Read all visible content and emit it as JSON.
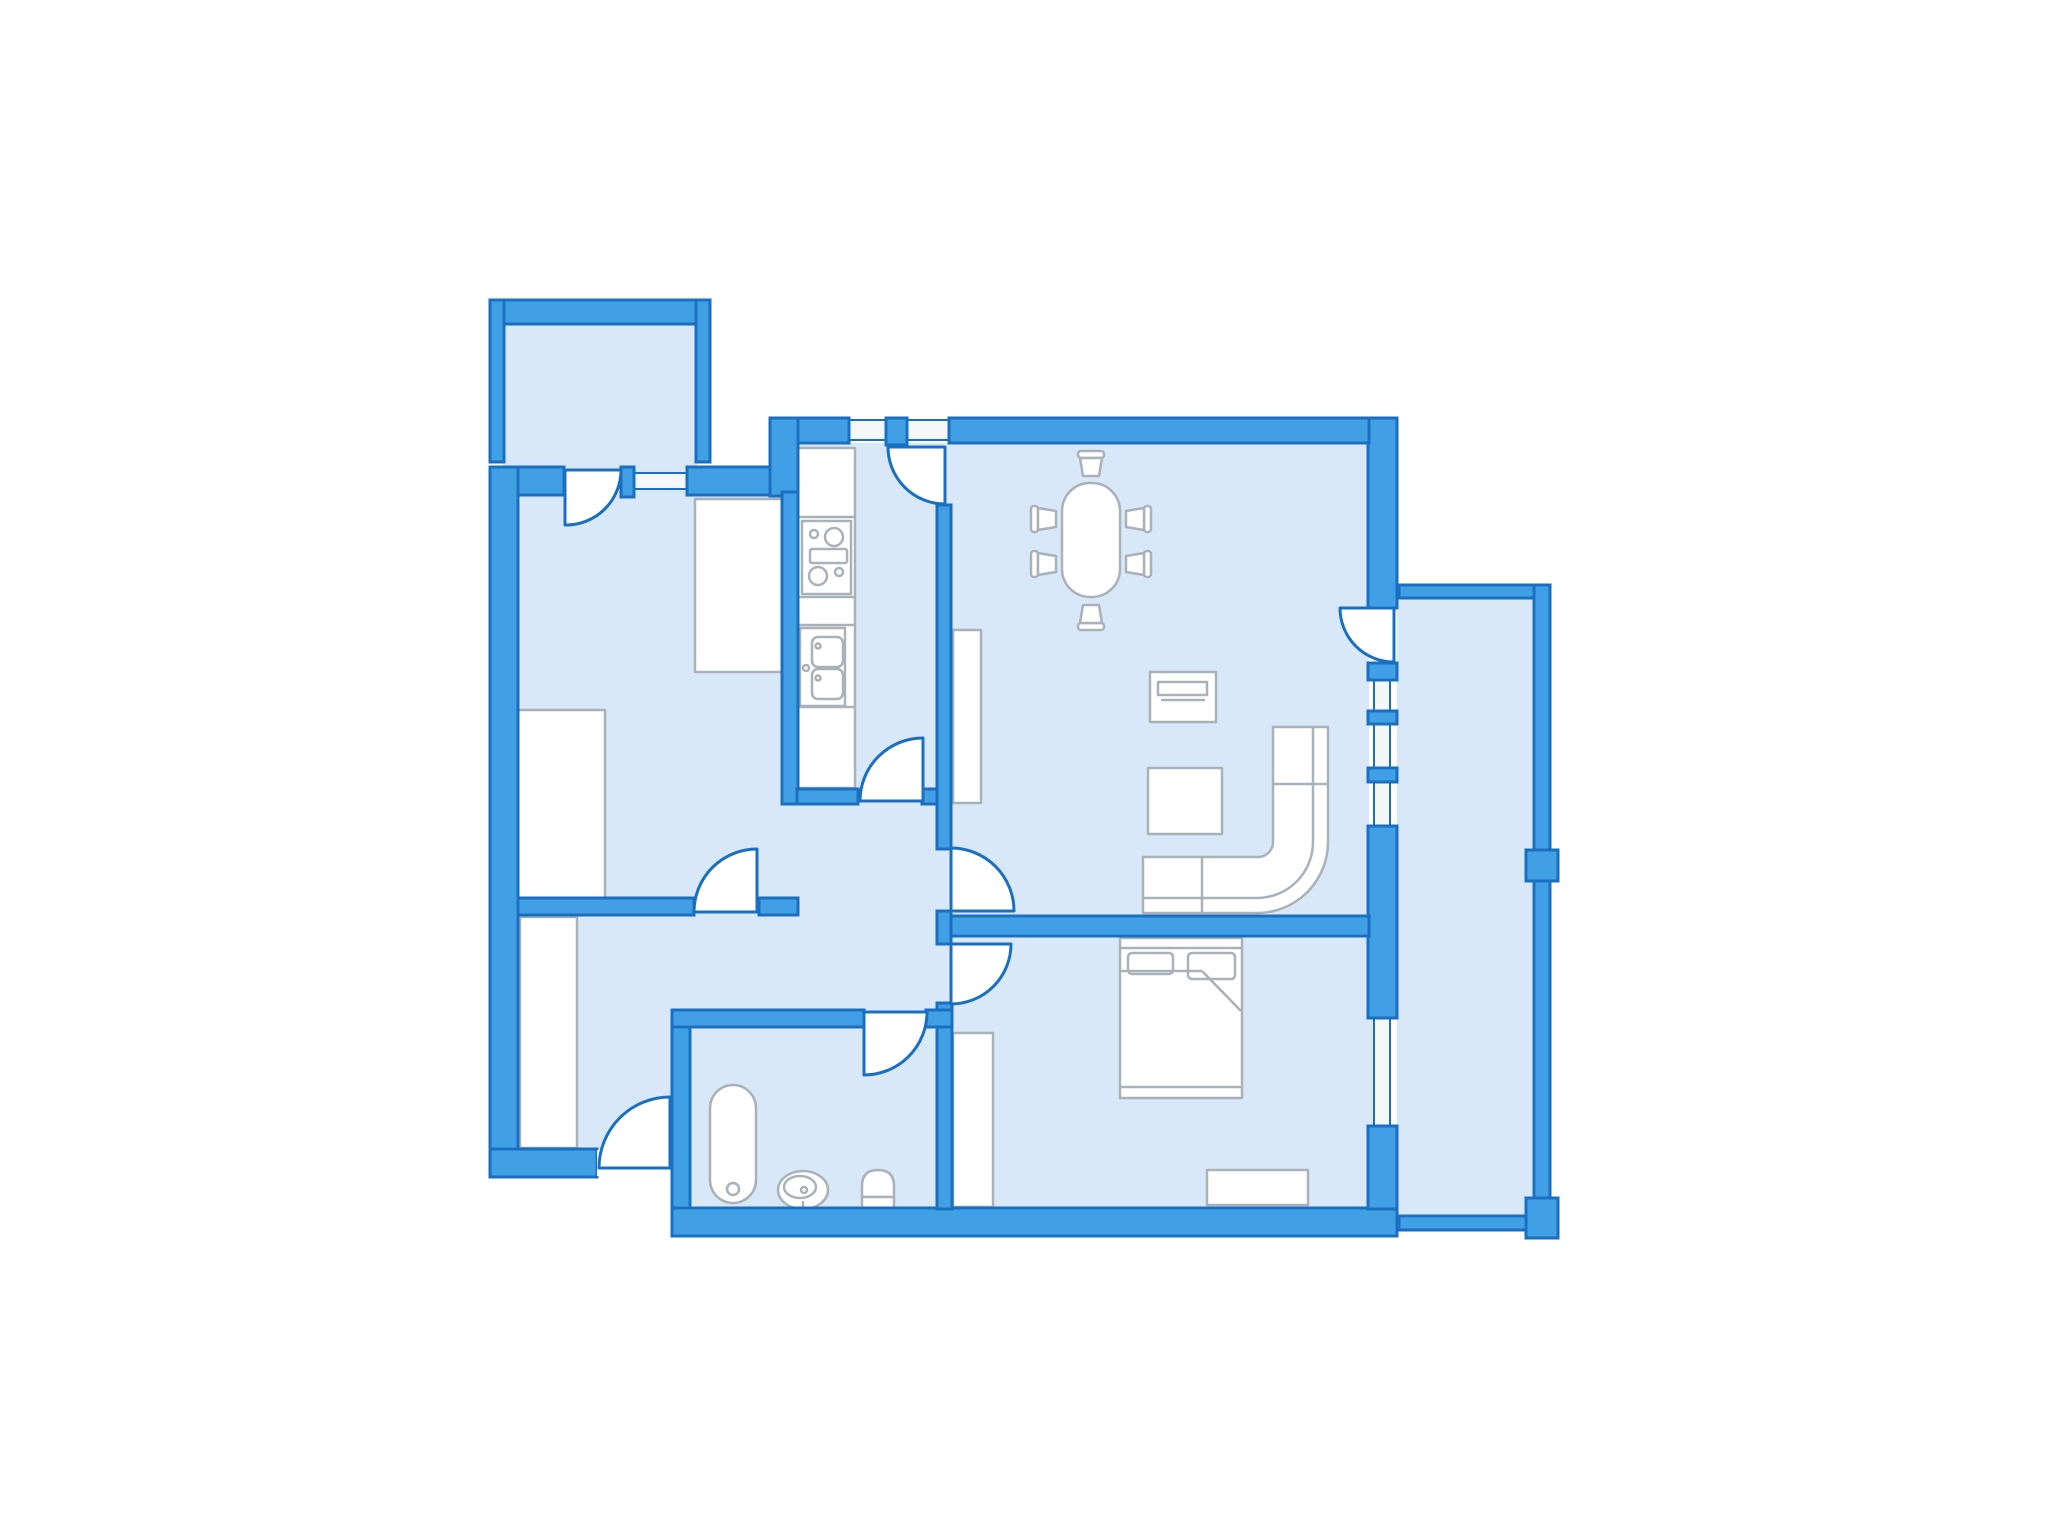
{
  "title": "apartment-floor-plan",
  "colors": {
    "background": "#ffffff",
    "wall_fill": "#41a0e5",
    "wall_stroke": "#1a6fc0",
    "room_fill": "#d9e8f8",
    "window_fill": "#f4f7fa",
    "door_fill": "#ffffff",
    "door_stroke": "#1a6fc0",
    "furniture_fill": "#ffffff",
    "furniture_stroke": "#a9b1b9"
  },
  "plan": {
    "rooms": [
      "balcony-top-left",
      "room-top-left",
      "entry-hall",
      "hallway",
      "kitchen",
      "living-room",
      "bedroom",
      "bathroom",
      "balcony-right"
    ],
    "furniture": [
      "wardrobe",
      "kitchen-counter",
      "stove-cooktop",
      "kitchen-sink",
      "dining-table",
      "dining-chair",
      "tv-stand",
      "coffee-table",
      "corner-sofa",
      "shelf",
      "double-bed",
      "dresser",
      "bathtub",
      "washbasin",
      "toilet"
    ],
    "openings": {
      "doors": 9,
      "windows": 5
    }
  }
}
